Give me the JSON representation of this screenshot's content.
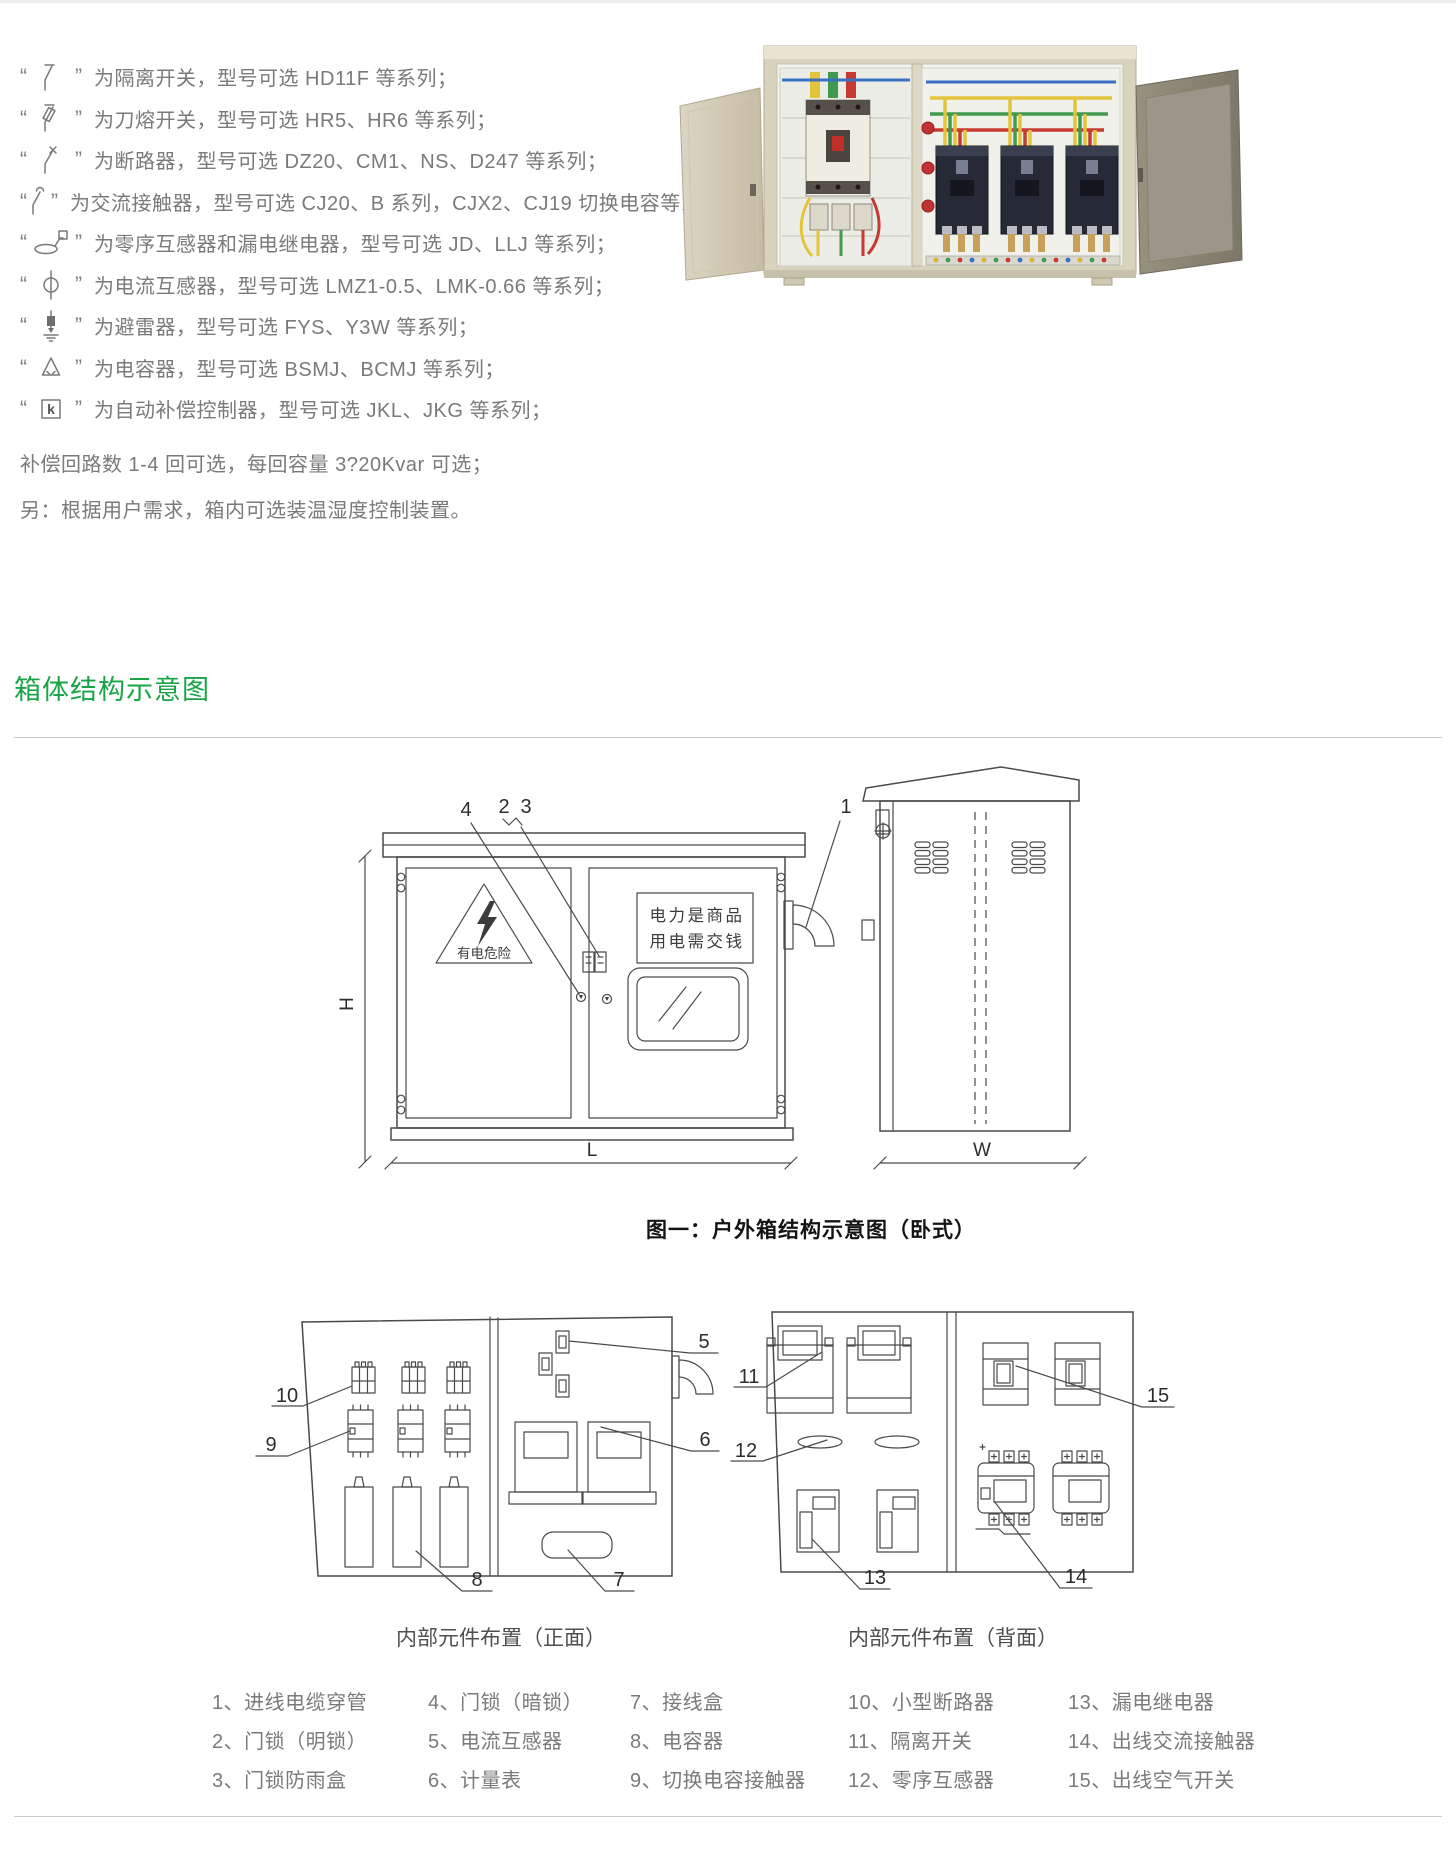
{
  "section_title": "箱体结构示意图",
  "colors": {
    "accent_green": "#1aa447",
    "text_gray": "#7a7a7a",
    "drawing_gray": "#4a4a4a",
    "rule_gray": "#c9c9c9"
  },
  "symbol_list": {
    "quote_open": "“",
    "quote_close": "”",
    "items": [
      {
        "symbol": "isolator-switch",
        "text": "为隔离开关，型号可选 HD11F 等系列；"
      },
      {
        "symbol": "knife-fuse-switch",
        "text": "为刀熔开关，型号可选 HR5、HR6 等系列；"
      },
      {
        "symbol": "circuit-breaker",
        "text": "为断路器，型号可选 DZ20、CM1、NS、D247 等系列；"
      },
      {
        "symbol": "ac-contactor",
        "text": "为交流接触器，型号可选 CJ20、B 系列，CJX2、CJ19 切换电容等系列；"
      },
      {
        "symbol": "zero-sequence-ct-and-leakage-relay",
        "text": "为零序互感器和漏电继电器，型号可选 JD、LLJ 等系列；"
      },
      {
        "symbol": "current-transformer",
        "text": "为电流互感器，型号可选 LMZ1-0.5、LMK-0.66 等系列；"
      },
      {
        "symbol": "surge-arrester",
        "text": "为避雷器，型号可选 FYS、Y3W 等系列；"
      },
      {
        "symbol": "capacitor",
        "text": "为电容器，型号可选 BSMJ、BCMJ 等系列；"
      },
      {
        "symbol": "auto-compensation-controller",
        "symbol_char": "k",
        "text": "为自动补偿控制器，型号可选 JKL、JKG 等系列；"
      }
    ],
    "note_loops": "补偿回路数 1-4 回可选，每回容量 3?20Kvar 可选；",
    "note_extra": "另：根据用户需求，箱内可选装温湿度控制装置。"
  },
  "figure1": {
    "caption": "图一：户外箱结构示意图（卧式）",
    "warning_label": "有电危险",
    "sign_line1": "电力是商品",
    "sign_line2": "用电需交钱",
    "dim_H": "H",
    "dim_L": "L",
    "dim_W": "W",
    "callout_1": "1",
    "callout_2": "2",
    "callout_3": "3",
    "callout_4": "4"
  },
  "figure2": {
    "front_caption": "内部元件布置（正面）",
    "back_caption": "内部元件布置（背面）",
    "callout_5": "5",
    "callout_6": "6",
    "callout_7": "7",
    "callout_8": "8",
    "callout_9": "9",
    "callout_10": "10",
    "callout_11": "11",
    "callout_12": "12",
    "callout_13": "13",
    "callout_14": "14",
    "callout_15": "15"
  },
  "legend": {
    "items": [
      {
        "no": "1、",
        "label": "进线电缆穿管"
      },
      {
        "no": "2、",
        "label": "门锁（明锁）"
      },
      {
        "no": "3、",
        "label": "门锁防雨盒"
      },
      {
        "no": "4、",
        "label": "门锁（暗锁）"
      },
      {
        "no": "5、",
        "label": "电流互感器"
      },
      {
        "no": "6、",
        "label": "计量表"
      },
      {
        "no": "7、",
        "label": "接线盒"
      },
      {
        "no": "8、",
        "label": "电容器"
      },
      {
        "no": "9、",
        "label": "切换电容接触器"
      },
      {
        "no": "10、",
        "label": "小型断路器"
      },
      {
        "no": "11、",
        "label": "隔离开关"
      },
      {
        "no": "12、",
        "label": "零序互感器"
      },
      {
        "no": "13、",
        "label": "漏电继电器"
      },
      {
        "no": "14、",
        "label": "出线交流接触器"
      },
      {
        "no": "15、",
        "label": "出线空气开关"
      }
    ]
  }
}
